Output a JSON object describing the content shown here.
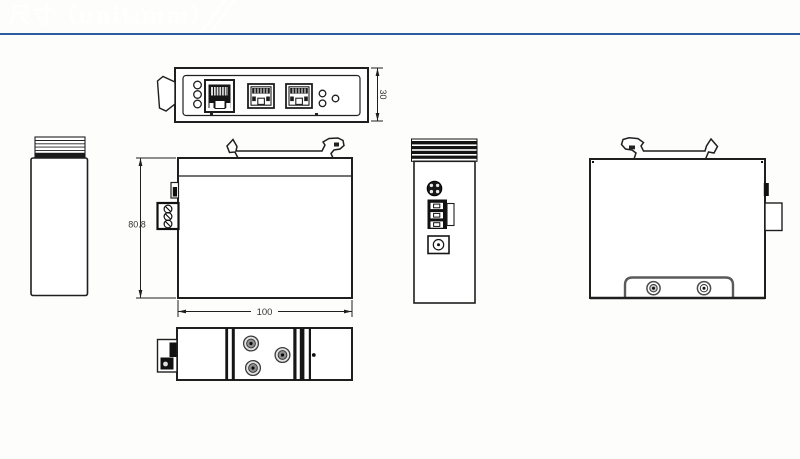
{
  "header": {
    "title": "尺寸（unit:mm）"
  },
  "colors": {
    "banner_dark": "#16407e",
    "banner_mid": "#3e6fa8",
    "banner_light": "#e9eff7",
    "underline": "#2a5d9e",
    "drawing_line": "#1f1f1f"
  },
  "dimensions": {
    "depth": "30",
    "height": "80.8",
    "width": "100"
  }
}
